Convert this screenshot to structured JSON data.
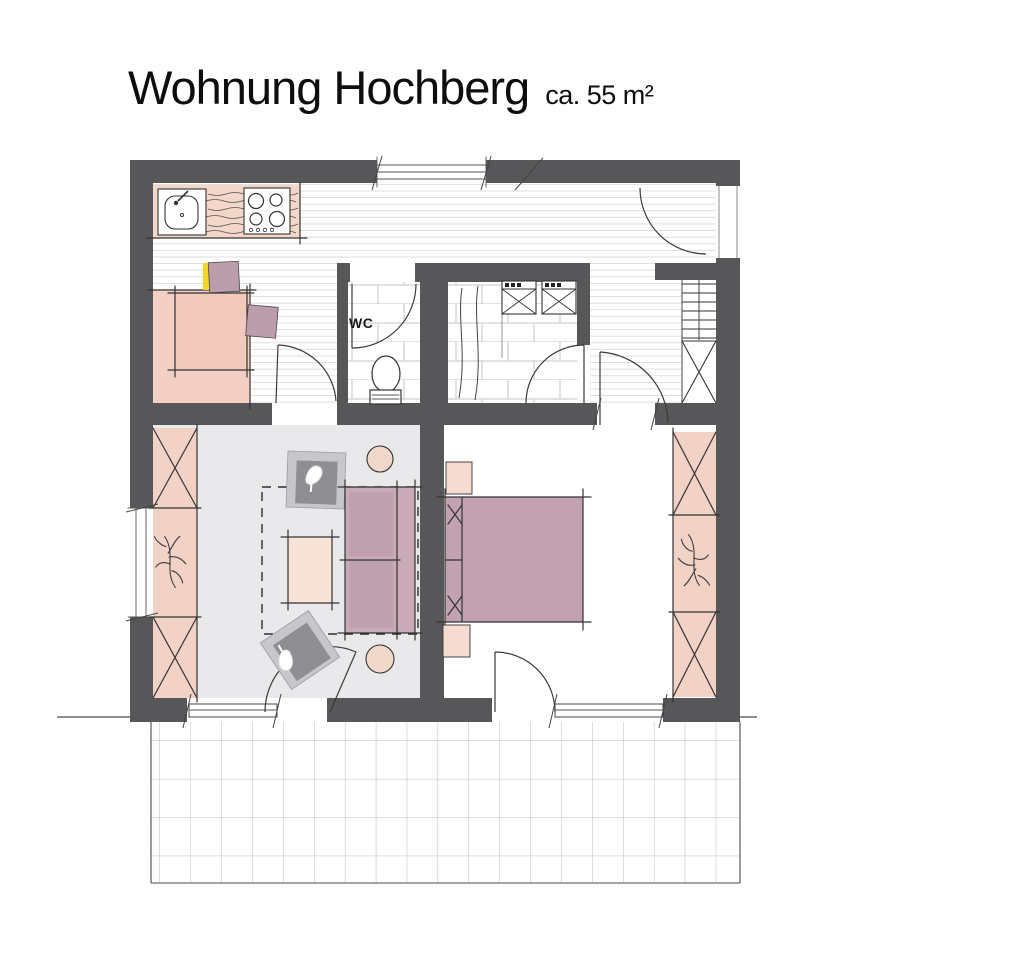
{
  "header": {
    "title": "Wohnung Hochberg",
    "area_label": "ca. 55 m²"
  },
  "plan": {
    "labels": {
      "wc": "WC"
    },
    "icons": [
      "sink-icon",
      "stove-icon",
      "toilet-icon",
      "washer-icon",
      "shower-curtain-icon",
      "stairs-icon",
      "plant-icon",
      "sofa-icon",
      "armchair-icon",
      "bed-icon",
      "wardrobe-icon",
      "table-icon",
      "chair-icon",
      "pouf-icon",
      "door-swing-icon",
      "window-icon",
      "terrace-grid-icon"
    ]
  },
  "colors": {
    "wall": "#57575a",
    "counter_salmon": "#f5d7c9",
    "dining_zone": "#f3d0c3",
    "table_pink": "#f1cabc",
    "chair_mauve": "#bb9dab",
    "sofa_mauve": "#c9aab6",
    "cushion_mauve": "#bfa0ae",
    "bed_mauve": "#c2a2b0",
    "wardrobe_pink": "#f3d2c6",
    "nightstand_pink": "#f6dcd0",
    "pouf_pink": "#f2d7cb",
    "living_floor": "#e9e9eb",
    "armchair_outer": "#c7c7cb",
    "armchair_inner": "#8f8f93",
    "highlight_yellow": "#f6d42e",
    "floor_line": "#d8d8d8",
    "tile_line": "#c6c6c6",
    "terrace_line": "#ababab"
  }
}
